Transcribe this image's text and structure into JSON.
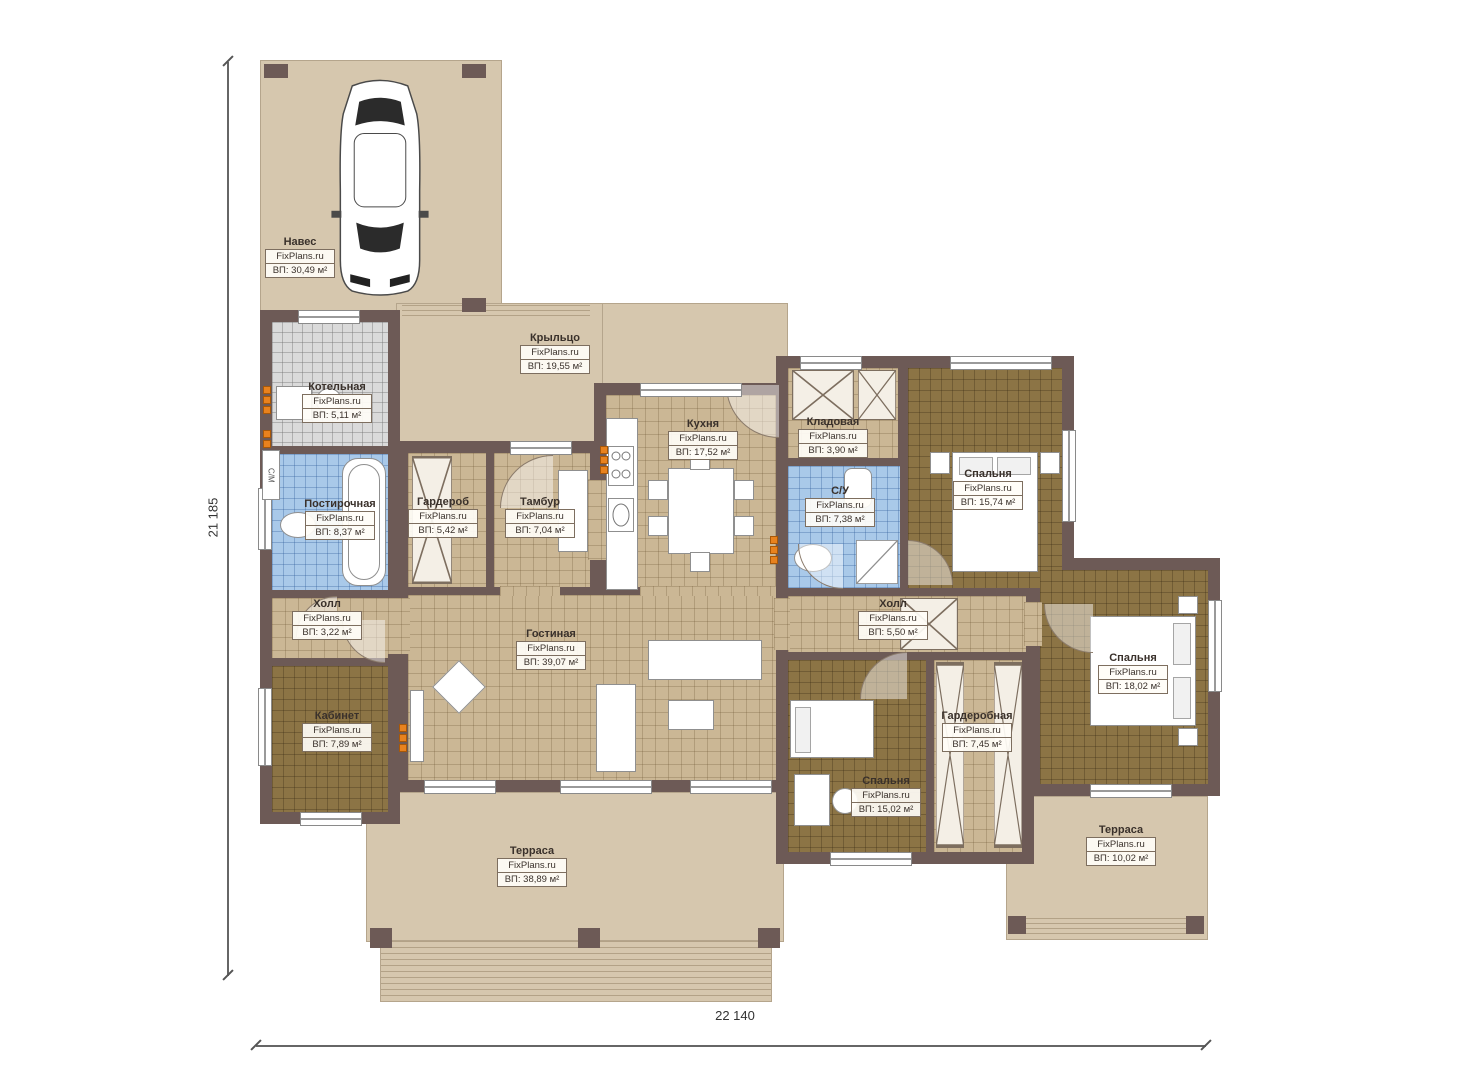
{
  "brand": "FixPlans.ru",
  "dimensions": {
    "height_label": "21 185",
    "width_label": "22 140"
  },
  "labels_misc": {
    "machine": "С/М"
  },
  "colors": {
    "wall": "#6d5a56",
    "outdoor_paving": "#d6c7ae",
    "floor_tan": "#cbb795",
    "floor_dark": "#8c7445",
    "tile_blue": "#a9c9e9",
    "tile_gray": "#dadada",
    "radiator": "#e8821e"
  },
  "rooms": [
    {
      "id": "carport",
      "name": "Навес",
      "brand": "FixPlans.ru",
      "area": "ВП: 30,49 м²"
    },
    {
      "id": "porch",
      "name": "Крыльцо",
      "brand": "FixPlans.ru",
      "area": "ВП: 19,55 м²"
    },
    {
      "id": "boiler",
      "name": "Котельная",
      "brand": "FixPlans.ru",
      "area": "ВП: 5,11 м²"
    },
    {
      "id": "laundry",
      "name": "Постирочная",
      "brand": "FixPlans.ru",
      "area": "ВП: 8,37 м²"
    },
    {
      "id": "wardrobe",
      "name": "Гардероб",
      "brand": "FixPlans.ru",
      "area": "ВП: 5,42 м²"
    },
    {
      "id": "vestibule",
      "name": "Тамбур",
      "brand": "FixPlans.ru",
      "area": "ВП: 7,04 м²"
    },
    {
      "id": "kitchen",
      "name": "Кухня",
      "brand": "FixPlans.ru",
      "area": "ВП: 17,52 м²"
    },
    {
      "id": "pantry",
      "name": "Кладовая",
      "brand": "FixPlans.ru",
      "area": "ВП: 3,90 м²"
    },
    {
      "id": "bathroom",
      "name": "С/У",
      "brand": "FixPlans.ru",
      "area": "ВП: 7,38 м²"
    },
    {
      "id": "bedroom1",
      "name": "Спальня",
      "brand": "FixPlans.ru",
      "area": "ВП: 15,74 м²"
    },
    {
      "id": "hall1",
      "name": "Холл",
      "brand": "FixPlans.ru",
      "area": "ВП: 3,22 м²"
    },
    {
      "id": "hall2",
      "name": "Холл",
      "brand": "FixPlans.ru",
      "area": "ВП: 5,50 м²"
    },
    {
      "id": "living",
      "name": "Гостиная",
      "brand": "FixPlans.ru",
      "area": "ВП: 39,07 м²"
    },
    {
      "id": "study",
      "name": "Кабинет",
      "brand": "FixPlans.ru",
      "area": "ВП: 7,89 м²"
    },
    {
      "id": "closet",
      "name": "Гардеробная",
      "brand": "FixPlans.ru",
      "area": "ВП: 7,45 м²"
    },
    {
      "id": "bedroom2",
      "name": "Спальня",
      "brand": "FixPlans.ru",
      "area": "ВП: 15,02 м²"
    },
    {
      "id": "bedroom3",
      "name": "Спальня",
      "brand": "FixPlans.ru",
      "area": "ВП: 18,02 м²"
    },
    {
      "id": "terrace1",
      "name": "Терраса",
      "brand": "FixPlans.ru",
      "area": "ВП: 38,89 м²"
    },
    {
      "id": "terrace2",
      "name": "Терраса",
      "brand": "FixPlans.ru",
      "area": "ВП: 10,02 м²"
    }
  ]
}
